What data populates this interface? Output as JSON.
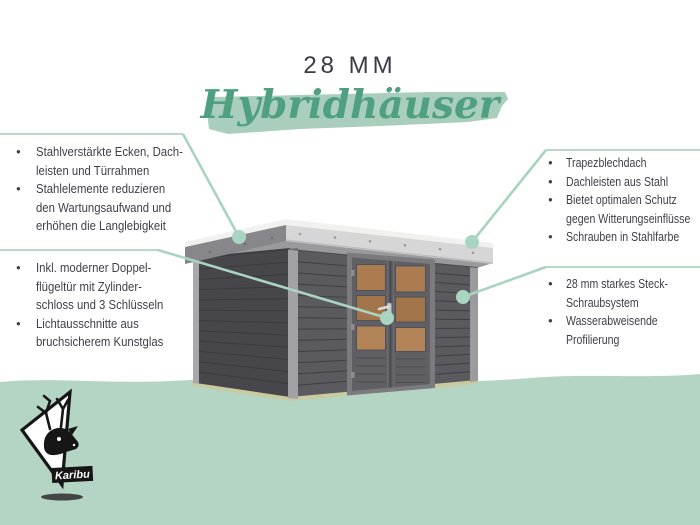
{
  "header": {
    "kicker": "28 MM",
    "title": "Hybridhäuser"
  },
  "callouts": {
    "left_top": {
      "items": [
        {
          "lines": [
            "Stahlverstärkte Ecken, Dach-",
            "leisten und Türrahmen"
          ]
        },
        {
          "lines": [
            "Stahlelemente reduzieren",
            "den Wartungsaufwand und",
            "erhöhen die Langlebigkeit"
          ]
        }
      ]
    },
    "left_bottom": {
      "items": [
        {
          "lines": [
            "Inkl. moderner Doppel-",
            "flügeltür mit Zylinder-",
            "schloss und 3 Schlüsseln"
          ]
        },
        {
          "lines": [
            "Lichtausschnitte aus",
            "bruchsicherem Kunstglas"
          ]
        }
      ]
    },
    "right_top": {
      "items": [
        {
          "lines": [
            "Trapezblechdach"
          ]
        },
        {
          "lines": [
            "Dachleisten aus Stahl"
          ]
        },
        {
          "lines": [
            "Bietet optimalen Schutz",
            "gegen Witterungseinflüsse"
          ]
        },
        {
          "lines": [
            "Schrauben in Stahlfarbe"
          ]
        }
      ]
    },
    "right_bottom": {
      "items": [
        {
          "lines": [
            "28 mm starkes Steck-",
            "Schraubsystem"
          ]
        },
        {
          "lines": [
            "Wasserabweisende",
            "Profilierung"
          ]
        }
      ]
    }
  },
  "logo": {
    "brand": "Karibu"
  },
  "illustration": {
    "subject": "gray flat-roof hybrid garden house with steel-reinforced double door"
  },
  "colors": {
    "script_green": "#4f9f81",
    "brush_green": "#a9cebb",
    "band_green": "#b5d5c4",
    "line_green": "#a9d4c1",
    "text_dark": "#3e3e47",
    "wall_dark": "#5a5a5f",
    "roof_light": "#d6d6d6",
    "window_amber": "#a87a4e"
  }
}
